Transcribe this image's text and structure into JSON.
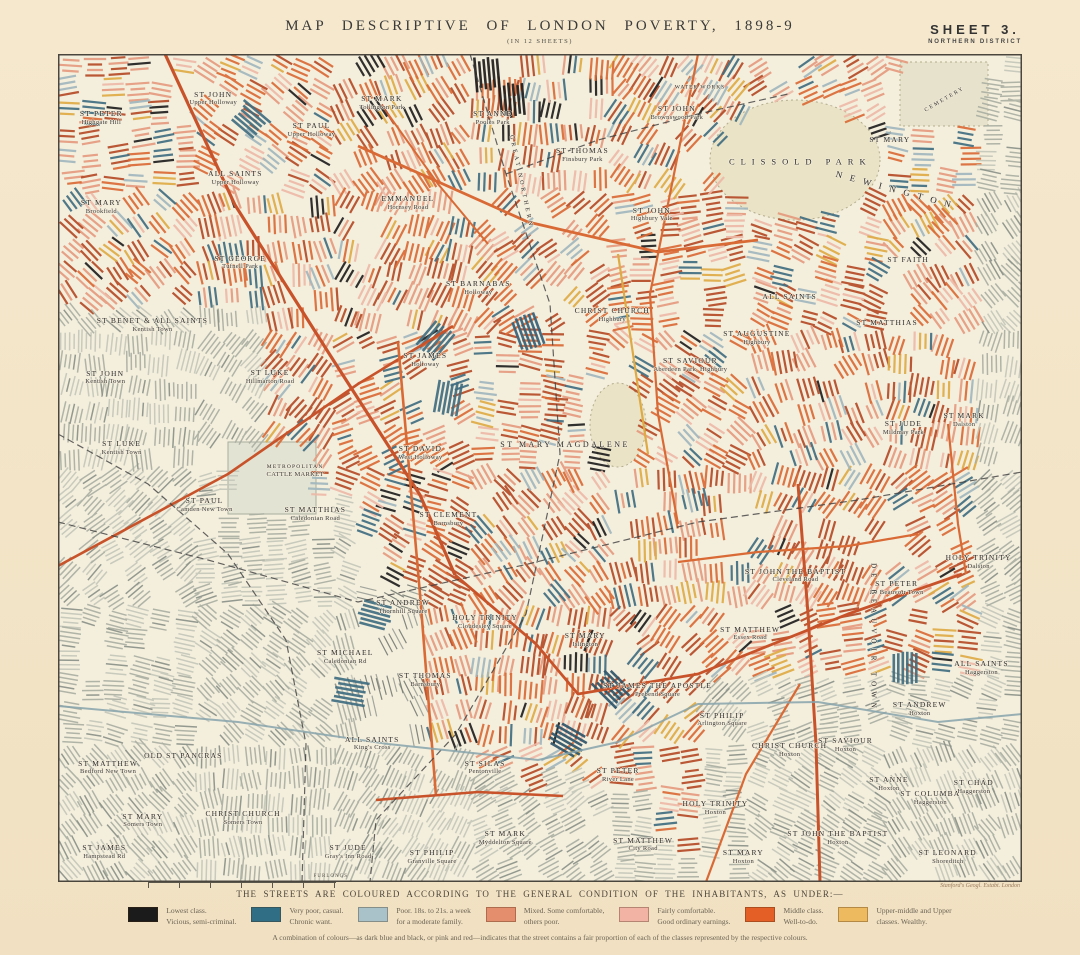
{
  "sheet": {
    "title": "MAP DESCRIPTIVE OF LONDON POVERTY, 1898-9",
    "subtitle": "(IN 12 SHEETS)",
    "sheet_label": "SHEET 3.",
    "district_label": "NORTHERN DISTRICT",
    "attribution": "Stanford's Geogl. Estabt. London",
    "scale_label": "FURLONGS"
  },
  "legend": {
    "heading": "THE STREETS ARE COLOURED ACCORDING TO THE GENERAL CONDITION OF THE INHABITANTS, AS UNDER:—",
    "items": [
      {
        "class_name": "lowest",
        "color": "#1b1b1b",
        "line1": "Lowest class.",
        "line2": "Vicious, semi-criminal."
      },
      {
        "class_name": "very-poor",
        "color": "#2f6e84",
        "line1": "Very poor, casual.",
        "line2": "Chronic want."
      },
      {
        "class_name": "poor",
        "color": "#a9c2ca",
        "line1": "Poor.  18s. to 21s. a week",
        "line2": "for a moderate family."
      },
      {
        "class_name": "mixed",
        "color": "#e58e6e",
        "line1": "Mixed.  Some comfortable,",
        "line2": "others poor."
      },
      {
        "class_name": "fairly-comfortable",
        "color": "#f2b3a5",
        "line1": "Fairly comfortable.",
        "line2": "Good ordinary earnings."
      },
      {
        "class_name": "middle-class",
        "color": "#e45f26",
        "line1": "Middle class.",
        "line2": "Well-to-do."
      },
      {
        "class_name": "wealthy",
        "color": "#eeba60",
        "line1": "Upper-middle and Upper",
        "line2": "classes.  Wealthy."
      }
    ],
    "footnote": "A combination of colours—as dark blue and black, or pink and red—indicates that the street contains a fair proportion of each of the classes represented by the respective colours."
  },
  "map": {
    "labels": [
      {
        "name": "ST PETER",
        "sub": "Highgate Hill",
        "x": 4.5,
        "y": 7.7
      },
      {
        "name": "ST JOHN",
        "sub": "Upper Holloway",
        "x": 16.1,
        "y": 5.4
      },
      {
        "name": "ST PAUL",
        "sub": "Upper Holloway",
        "x": 26.3,
        "y": 9.2
      },
      {
        "name": "ST MARK",
        "sub": "Tollington Park",
        "x": 33.6,
        "y": 5.9
      },
      {
        "name": "ST ANNE",
        "sub": "Pooles Park",
        "x": 45.1,
        "y": 7.7
      },
      {
        "name": "ST JOHN",
        "sub": "Brownswood Park",
        "x": 64.2,
        "y": 7.1
      },
      {
        "name": "WATER WORKS",
        "x": 66.6,
        "y": 4.1,
        "size": 5.5,
        "ls": 1
      },
      {
        "name": "CEMETERY",
        "x": 92.0,
        "y": 5.5,
        "size": 5.5,
        "ls": 2,
        "rot": -30
      },
      {
        "name": "ST MARY",
        "x": 86.3,
        "y": 10.4
      },
      {
        "name": "CLISSOLD PARK",
        "x": 77.0,
        "y": 13.0,
        "size": 8.5,
        "ls": 6
      },
      {
        "name": "NEWINGTON",
        "x": 87.0,
        "y": 16.5,
        "size": 9,
        "ls": 8,
        "rot": 15
      },
      {
        "name": "GREAT NORTHERN",
        "x": 47.9,
        "y": 15.5,
        "size": 6,
        "ls": 3,
        "rot": 78
      },
      {
        "name": "ALL SAINTS",
        "sub": "Upper Holloway",
        "x": 18.4,
        "y": 15.0
      },
      {
        "name": "EMMANUEL",
        "sub": "Hornsey Road",
        "x": 36.3,
        "y": 18.0
      },
      {
        "name": "ST THOMAS",
        "sub": "Finsbury Park",
        "x": 54.4,
        "y": 12.2
      },
      {
        "name": "ST MARY",
        "sub": "Brookfield",
        "x": 4.5,
        "y": 18.5
      },
      {
        "name": "ST JOHN",
        "sub": "Highbury Vale",
        "x": 61.6,
        "y": 19.4
      },
      {
        "name": "ST GEORGE",
        "sub": "Tufnell Park",
        "x": 18.9,
        "y": 25.2
      },
      {
        "name": "ST FAITH",
        "x": 88.2,
        "y": 24.9
      },
      {
        "name": "ALL SAINTS",
        "x": 75.9,
        "y": 29.3
      },
      {
        "name": "ST MATTHIAS",
        "x": 86.0,
        "y": 32.5
      },
      {
        "name": "ST BARNABAS",
        "sub": "Holloway",
        "x": 43.6,
        "y": 28.3
      },
      {
        "name": "ST BENET & ALL SAINTS",
        "sub": "Kentish Town",
        "x": 9.8,
        "y": 32.7
      },
      {
        "name": "CHRIST CHURCH",
        "sub": "Highbury",
        "x": 57.5,
        "y": 31.5
      },
      {
        "name": "ST AUGUSTINE",
        "sub": "Highbury",
        "x": 72.5,
        "y": 34.3
      },
      {
        "name": "ST SAVIOUR",
        "sub": "Aberdeen Park, Highbury",
        "x": 65.6,
        "y": 37.6
      },
      {
        "name": "ST JOHN",
        "sub": "Kentish Town",
        "x": 4.9,
        "y": 39.1
      },
      {
        "name": "ST JAMES",
        "sub": "Holloway",
        "x": 38.1,
        "y": 37.0
      },
      {
        "name": "ST LUKE",
        "sub": "Hillmarton Road",
        "x": 22.0,
        "y": 39.0
      },
      {
        "name": "ST MARY MAGDALENE",
        "x": 52.6,
        "y": 47.2,
        "size": 8,
        "ls": 2.5
      },
      {
        "name": "ST DAVID",
        "sub": "West Holloway",
        "x": 37.6,
        "y": 48.2
      },
      {
        "name": "ST LUKE",
        "sub": "Kentish Town",
        "x": 6.6,
        "y": 47.6
      },
      {
        "name": "METROPOLITAN",
        "sub": "CATTLE MARKET",
        "x": 24.6,
        "y": 50.5,
        "size": 5.5
      },
      {
        "name": "ST JUDE",
        "sub": "Mildmay Park",
        "x": 87.7,
        "y": 45.2
      },
      {
        "name": "ST MARK",
        "sub": "Dalston",
        "x": 94.0,
        "y": 44.2
      },
      {
        "name": "ST PAUL",
        "sub": "Camden New Town",
        "x": 15.2,
        "y": 54.5
      },
      {
        "name": "ST MATTHIAS",
        "sub": "Caledonian Road",
        "x": 26.7,
        "y": 55.6
      },
      {
        "name": "ST CLEMENT",
        "sub": "Barnsbury",
        "x": 40.5,
        "y": 56.2
      },
      {
        "name": "HOLY TRINITY",
        "sub": "Dalston",
        "x": 95.5,
        "y": 61.4
      },
      {
        "name": "ST PETER",
        "sub": "De Beauvoir Town",
        "x": 87.0,
        "y": 64.5
      },
      {
        "name": "DE BEAUVOIR TOWN",
        "x": 84.5,
        "y": 70.5,
        "size": 7,
        "ls": 5,
        "rot": 90
      },
      {
        "name": "ST JOHN THE BAPTIST",
        "sub": "Cleveland Road",
        "x": 76.5,
        "y": 63.0
      },
      {
        "name": "ST MATTHEW",
        "sub": "Essex Road",
        "x": 71.8,
        "y": 70.0
      },
      {
        "name": "ST ANDREW",
        "sub": "Thornhill Square",
        "x": 35.8,
        "y": 66.8
      },
      {
        "name": "HOLY TRINITY",
        "sub": "Cloudesley Square",
        "x": 44.3,
        "y": 68.6
      },
      {
        "name": "ST MARY",
        "sub": "Islington",
        "x": 54.7,
        "y": 70.8
      },
      {
        "name": "ST MICHAEL",
        "sub": "Caledonian Rd",
        "x": 29.8,
        "y": 72.8
      },
      {
        "name": "ST THOMAS",
        "sub": "Barnsbury",
        "x": 38.1,
        "y": 75.6
      },
      {
        "name": "ST JAMES THE APOSTLE",
        "sub": "Prebend Square",
        "x": 62.2,
        "y": 76.8
      },
      {
        "name": "ST PHILIP",
        "sub": "Arlington Square",
        "x": 68.9,
        "y": 80.4
      },
      {
        "name": "ST PETER",
        "sub": "River Lane",
        "x": 58.1,
        "y": 87.1
      },
      {
        "name": "ST SILAS",
        "sub": "Pentonville",
        "x": 44.3,
        "y": 86.2
      },
      {
        "name": "ALL SAINTS",
        "sub": "King's Cross",
        "x": 32.6,
        "y": 83.3
      },
      {
        "name": "OLD ST PANCRAS",
        "x": 13.0,
        "y": 84.8
      },
      {
        "name": "ST MATTHEW",
        "sub": "Bedford New Town",
        "x": 5.2,
        "y": 86.2
      },
      {
        "name": "ST MARY",
        "sub": "Somers Town",
        "x": 8.8,
        "y": 92.6
      },
      {
        "name": "CHRIST CHURCH",
        "sub": "Somers Town",
        "x": 19.2,
        "y": 92.3
      },
      {
        "name": "ST JAMES",
        "sub": "Hampstead Rd",
        "x": 4.8,
        "y": 96.4
      },
      {
        "name": "ST JUDE",
        "sub": "Gray's Inn Road",
        "x": 30.1,
        "y": 96.4
      },
      {
        "name": "ST PHILIP",
        "sub": "Granville Square",
        "x": 38.8,
        "y": 97.0
      },
      {
        "name": "ST MARK",
        "sub": "Myddelton Square",
        "x": 46.4,
        "y": 94.7
      },
      {
        "name": "ST MATTHEW",
        "sub": "City Road",
        "x": 60.7,
        "y": 95.5
      },
      {
        "name": "ST MARY",
        "sub": "Hoxton",
        "x": 71.1,
        "y": 97.0
      },
      {
        "name": "HOLY TRINITY",
        "sub": "Hoxton",
        "x": 68.2,
        "y": 91.1
      },
      {
        "name": "ST JOHN THE BAPTIST",
        "sub": "Hoxton",
        "x": 80.9,
        "y": 94.7
      },
      {
        "name": "ST LEONARD",
        "sub": "Shoreditch",
        "x": 92.3,
        "y": 97.0
      },
      {
        "name": "CHRIST CHURCH",
        "sub": "Hoxton",
        "x": 75.9,
        "y": 84.1
      },
      {
        "name": "ST SAVIOUR",
        "sub": "Hoxton",
        "x": 81.7,
        "y": 83.5
      },
      {
        "name": "ST ANDREW",
        "sub": "Hoxton",
        "x": 89.4,
        "y": 79.1
      },
      {
        "name": "ST ANNE",
        "sub": "Hoxton",
        "x": 86.2,
        "y": 88.2
      },
      {
        "name": "ST COLUMBA",
        "sub": "Haggerston",
        "x": 90.5,
        "y": 89.9
      },
      {
        "name": "ST CHAD",
        "sub": "Haggerston",
        "x": 95.0,
        "y": 88.5
      },
      {
        "name": "ALL SAINTS",
        "sub": "Haggerston",
        "x": 95.8,
        "y": 74.2
      }
    ]
  }
}
